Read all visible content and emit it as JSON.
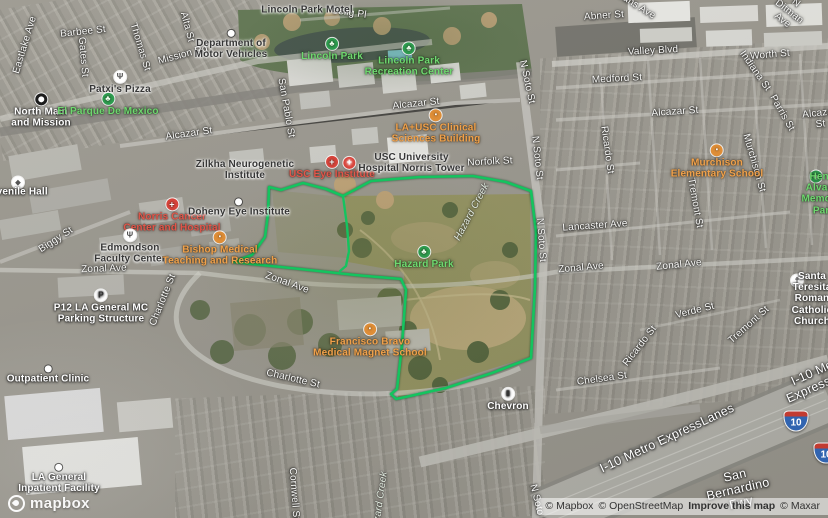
{
  "map": {
    "polygon_color": "#14c45f",
    "boundary": {
      "outer": [
        [
          269,
          187
        ],
        [
          281,
          190
        ],
        [
          303,
          183
        ],
        [
          326,
          189
        ],
        [
          343,
          196
        ],
        [
          371,
          181
        ],
        [
          420,
          177
        ],
        [
          473,
          176
        ],
        [
          506,
          182
        ],
        [
          531,
          191
        ],
        [
          536,
          232
        ],
        [
          535,
          287
        ],
        [
          531,
          358
        ],
        [
          492,
          373
        ],
        [
          446,
          388
        ],
        [
          410,
          396
        ],
        [
          396,
          399
        ],
        [
          391,
          394
        ],
        [
          397,
          389
        ],
        [
          402,
          345
        ],
        [
          406,
          290
        ],
        [
          401,
          279
        ],
        [
          355,
          275
        ],
        [
          300,
          269
        ],
        [
          233,
          262
        ],
        [
          252,
          255
        ],
        [
          265,
          237
        ],
        [
          268,
          214
        ],
        [
          269,
          187
        ]
      ],
      "divider": [
        [
          343,
          196
        ],
        [
          347,
          226
        ],
        [
          349,
          251
        ],
        [
          346,
          266
        ],
        [
          340,
          271
        ]
      ]
    },
    "icon_glyphs": {
      "park": "♣",
      "hospital": "+",
      "school": "▪",
      "restaurant": "Ψ",
      "parking": "P",
      "fuel": "▮",
      "church": "†",
      "civic": "◆",
      "metro": "",
      "dot": ""
    },
    "shields": [
      {
        "name": "interstate-10-shield",
        "x": 796,
        "y": 421,
        "label": "10"
      },
      {
        "name": "interstate-10-shield-clipped",
        "x": 826,
        "y": 453,
        "label": "10"
      }
    ],
    "labels": [
      {
        "name": "street-selig-pl",
        "text": "Selig Pl",
        "x": 349,
        "y": 13,
        "rot": 8,
        "cls": "street"
      },
      {
        "name": "street-abner-st",
        "text": "Abner St",
        "x": 604,
        "y": 16,
        "rot": -4,
        "cls": "street"
      },
      {
        "name": "street-n-ditman-ave",
        "text": "N Ditman Ave",
        "x": 789,
        "y": 12,
        "rot": 38,
        "cls": "street"
      },
      {
        "name": "street-evans-ave",
        "text": "Evans Ave",
        "x": 634,
        "y": 4,
        "rot": 32,
        "cls": "street"
      },
      {
        "name": "street-valley-blvd",
        "text": "Valley Blvd",
        "x": 653,
        "y": 51,
        "rot": -3,
        "cls": "street"
      },
      {
        "name": "street-worth-st",
        "text": "Worth St",
        "x": 770,
        "y": 55,
        "rot": -5,
        "cls": "street"
      },
      {
        "name": "street-medford-st",
        "text": "Medford St",
        "x": 617,
        "y": 79,
        "rot": -3,
        "cls": "street"
      },
      {
        "name": "street-alcazar-st-left",
        "text": "Alcazar St",
        "x": 189,
        "y": 134,
        "rot": -8,
        "cls": "street"
      },
      {
        "name": "street-alcazar-st-center",
        "text": "Alcazar St",
        "x": 416,
        "y": 104,
        "rot": -6,
        "cls": "street"
      },
      {
        "name": "street-alcazar-st-right",
        "text": "Alcazar St",
        "x": 675,
        "y": 112,
        "rot": -4,
        "cls": "street"
      },
      {
        "name": "street-alcazar-st-edge",
        "text": "Alcazar St",
        "x": 820,
        "y": 119,
        "rot": -6,
        "cls": "street"
      },
      {
        "name": "street-indiana-st",
        "text": "Indiana St",
        "x": 755,
        "y": 71,
        "rot": 55,
        "cls": "street"
      },
      {
        "name": "street-parris-st",
        "text": "Parris St",
        "x": 782,
        "y": 113,
        "rot": 60,
        "cls": "street"
      },
      {
        "name": "street-n-soto-st-1",
        "text": "N Soto St",
        "x": 527,
        "y": 82,
        "rot": 78,
        "cls": "street"
      },
      {
        "name": "street-n-soto-st-2",
        "text": "N Soto St",
        "x": 537,
        "y": 158,
        "rot": 84,
        "cls": "street"
      },
      {
        "name": "street-n-soto-st-3",
        "text": "N Soto St",
        "x": 541,
        "y": 240,
        "rot": 86,
        "cls": "street"
      },
      {
        "name": "street-n-soto-st-4",
        "text": "N Soto St",
        "x": 538,
        "y": 506,
        "rot": 76,
        "cls": "street"
      },
      {
        "name": "street-norfolk-st",
        "text": "Norfolk St",
        "x": 490,
        "y": 162,
        "rot": -3,
        "cls": "street"
      },
      {
        "name": "street-ricardo-st-north",
        "text": "Ricardo St",
        "x": 607,
        "y": 150,
        "rot": 82,
        "cls": "street"
      },
      {
        "name": "street-murchison-st",
        "text": "Murchison St",
        "x": 754,
        "y": 163,
        "rot": 74,
        "cls": "street"
      },
      {
        "name": "street-tremont-st-north",
        "text": "Tremont St",
        "x": 695,
        "y": 203,
        "rot": 80,
        "cls": "street"
      },
      {
        "name": "street-lancaster-ave",
        "text": "Lancaster Ave",
        "x": 595,
        "y": 226,
        "rot": -4,
        "cls": "street"
      },
      {
        "name": "street-zonal-ave-1",
        "text": "Zonal Ave",
        "x": 104,
        "y": 269,
        "rot": -2,
        "cls": "street"
      },
      {
        "name": "street-zonal-ave-2",
        "text": "Zonal Ave",
        "x": 287,
        "y": 283,
        "rot": 20,
        "cls": "street"
      },
      {
        "name": "street-zonal-ave-3",
        "text": "Zonal Ave",
        "x": 581,
        "y": 268,
        "rot": -5,
        "cls": "street"
      },
      {
        "name": "street-zonal-ave-4",
        "text": "Zonal Ave",
        "x": 679,
        "y": 265,
        "rot": -6,
        "cls": "street"
      },
      {
        "name": "street-charlotte-st-west",
        "text": "Charlotte St",
        "x": 163,
        "y": 300,
        "rot": -68,
        "cls": "street"
      },
      {
        "name": "street-charlotte-st-south",
        "text": "Charlotte St",
        "x": 293,
        "y": 379,
        "rot": 13,
        "cls": "street"
      },
      {
        "name": "street-biggy-st",
        "text": "Biggy St",
        "x": 56,
        "y": 240,
        "rot": -33,
        "cls": "street"
      },
      {
        "name": "street-mission-rd",
        "text": "Mission Rd",
        "x": 183,
        "y": 55,
        "rot": -15,
        "cls": "street"
      },
      {
        "name": "street-eastlake-ave",
        "text": "Eastlake Ave",
        "x": 25,
        "y": 45,
        "rot": -73,
        "cls": "street"
      },
      {
        "name": "street-barbee-st",
        "text": "Barbee St",
        "x": 83,
        "y": 32,
        "rot": -6,
        "cls": "street"
      },
      {
        "name": "street-gates-st",
        "text": "Gates St",
        "x": 83,
        "y": 57,
        "rot": 85,
        "cls": "street"
      },
      {
        "name": "street-thomas-st",
        "text": "Thomas St",
        "x": 140,
        "y": 47,
        "rot": 73,
        "cls": "street"
      },
      {
        "name": "street-alta-st",
        "text": "Alta St",
        "x": 187,
        "y": 27,
        "rot": 75,
        "cls": "street"
      },
      {
        "name": "street-san-pablo-st",
        "text": "San Pablo St",
        "x": 286,
        "y": 108,
        "rot": 80,
        "cls": "street"
      },
      {
        "name": "street-verde-st",
        "text": "Verde St",
        "x": 695,
        "y": 311,
        "rot": -14,
        "cls": "street"
      },
      {
        "name": "street-ricardo-st-south",
        "text": "Ricardo St",
        "x": 640,
        "y": 346,
        "rot": -52,
        "cls": "street"
      },
      {
        "name": "street-tremont-st-south",
        "text": "Tremont St",
        "x": 749,
        "y": 325,
        "rot": -42,
        "cls": "street"
      },
      {
        "name": "street-chelsea-st",
        "text": "Chelsea St",
        "x": 602,
        "y": 379,
        "rot": -8,
        "cls": "street"
      },
      {
        "name": "street-cornwell-st",
        "text": "Cornwell St",
        "x": 294,
        "y": 494,
        "rot": 86,
        "cls": "street"
      },
      {
        "name": "waterway-hazard-creek-1",
        "text": "Hazard Creek",
        "x": 472,
        "y": 212,
        "rot": -62,
        "cls": "creek"
      },
      {
        "name": "waterway-hazard-creek-2",
        "text": "Hazard Creek",
        "x": 380,
        "y": 503,
        "rot": -82,
        "cls": "creek"
      },
      {
        "name": "motorway-i10-metro-expresslanes",
        "text": "I-10 Metro ExpressLanes",
        "x": 667,
        "y": 438,
        "rot": -25,
        "cls": "motorway"
      },
      {
        "name": "motorway-i10-metro-expresslanes-edge",
        "text": "I-10 Metro ExpressLanes",
        "x": 822,
        "y": 376,
        "rot": -24,
        "cls": "motorway"
      },
      {
        "name": "motorway-san-bernardino-fwy",
        "text": "San Bernardino Fwy",
        "x": 738,
        "y": 489,
        "rot": -13,
        "cls": "motorway"
      },
      {
        "name": "poi-lincoln-park-motel",
        "text": "Lincoln Park Motel",
        "x": 307,
        "y": 10,
        "rot": 0,
        "cls": "poi-dark"
      },
      {
        "name": "poi-department-of-motor-vehicles",
        "text": "Department of\nMotor Vehicles",
        "x": 231,
        "y": 45,
        "rot": 0,
        "cls": "poi-dark",
        "icon": "dot"
      },
      {
        "name": "poi-patxis-pizza",
        "text": "Patxi's Pizza",
        "x": 120,
        "y": 83,
        "rot": 0,
        "cls": "poi-dark",
        "icon": "restaurant"
      },
      {
        "name": "poi-north-main-and-mission",
        "text": "North Main\nand Mission",
        "x": 41,
        "y": 111,
        "rot": 0,
        "cls": "poi-light",
        "icon": "metro"
      },
      {
        "name": "poi-el-parque-de-mexico",
        "text": "El Parque De Mexico",
        "x": 108,
        "y": 105,
        "rot": 0,
        "cls": "park",
        "icon": "park"
      },
      {
        "name": "poi-lincoln-park",
        "text": "Lincoln Park",
        "x": 332,
        "y": 50,
        "rot": 0,
        "cls": "park",
        "icon": "park"
      },
      {
        "name": "poi-lincoln-park-recreation-center",
        "text": "Lincoln Park\nRecreation Center",
        "x": 409,
        "y": 60,
        "rot": 0,
        "cls": "park",
        "icon": "park"
      },
      {
        "name": "poi-zilkha-neurogenetic-institute",
        "text": "Zilkha Neurogenetic\nInstitute",
        "x": 245,
        "y": 170,
        "rot": 0,
        "cls": "poi-dark"
      },
      {
        "name": "poi-usc-eye-institute",
        "text": "USC Eye Institute",
        "x": 332,
        "y": 168,
        "rot": 0,
        "cls": "hospital",
        "icon": "hospital"
      },
      {
        "name": "poi-usc-university-hospital-norris-tower",
        "text": "USC University\nHospital Norris Tower",
        "x": 404,
        "y": 163,
        "rot": 0,
        "cls": "poi-dark",
        "icon": "hospital",
        "iconpos": "left"
      },
      {
        "name": "poi-la-usc-clinical-sciences-building",
        "text": "LA+USC Clinical\nSciences Building",
        "x": 436,
        "y": 127,
        "rot": 0,
        "cls": "school",
        "icon": "school"
      },
      {
        "name": "poi-norris-cancer-center-and-hospital",
        "text": "Norris Cancer\nCenter and Hospital",
        "x": 172,
        "y": 216,
        "rot": 0,
        "cls": "hospital",
        "icon": "hospital"
      },
      {
        "name": "poi-doheny-eye-institute",
        "text": "Doheny Eye Institute",
        "x": 239,
        "y": 208,
        "rot": 0,
        "cls": "poi-dark",
        "icon": "dot"
      },
      {
        "name": "poi-edmondson-faculty-center",
        "text": "Edmondson\nFaculty Center",
        "x": 130,
        "y": 247,
        "rot": 0,
        "cls": "poi-dark",
        "icon": "restaurant"
      },
      {
        "name": "poi-bishop-medical-teaching-and-research",
        "text": "Bishop Medical\nTeaching and Research",
        "x": 220,
        "y": 249,
        "rot": 0,
        "cls": "school",
        "icon": "school"
      },
      {
        "name": "poi-central-juvenile-hall",
        "text": "Central Juvenile Hall",
        "x": -3,
        "y": 192,
        "rot": 0,
        "cls": "poi-light"
      },
      {
        "name": "poi-hazard-park",
        "text": "Hazard Park",
        "x": 424,
        "y": 258,
        "rot": 0,
        "cls": "park",
        "icon": "park"
      },
      {
        "name": "poi-henry-alvarez-memorial-park",
        "text": "Henry Alvarez\nMemorial Park",
        "x": 824,
        "y": 194,
        "rot": 0,
        "cls": "park"
      },
      {
        "name": "poi-murchison-elementary-school",
        "text": "Murchison\nElementary School",
        "x": 717,
        "y": 162,
        "rot": 0,
        "cls": "school",
        "icon": "school"
      },
      {
        "name": "poi-p12-la-general-mc-parking-structure",
        "text": "P12 LA General MC\nParking Structure",
        "x": 101,
        "y": 307,
        "rot": 0,
        "cls": "poi-light",
        "icon": "parking"
      },
      {
        "name": "poi-outpatient-clinic",
        "text": "Outpatient Clinic",
        "x": 48,
        "y": 375,
        "rot": 0,
        "cls": "poi-light",
        "icon": "dot"
      },
      {
        "name": "poi-francisco-bravo-medical-magnet-school",
        "text": "Francisco Bravo\nMedical Magnet School",
        "x": 370,
        "y": 341,
        "rot": 0,
        "cls": "school",
        "icon": "school"
      },
      {
        "name": "poi-la-general-inpatient-facility",
        "text": "LA General\nInpatient Facility",
        "x": 59,
        "y": 479,
        "rot": 0,
        "cls": "poi-light",
        "icon": "dot"
      },
      {
        "name": "poi-chevron",
        "text": "Chevron",
        "x": 508,
        "y": 400,
        "rot": 0,
        "cls": "poi-light",
        "icon": "fuel"
      },
      {
        "name": "poi-santa-teresita-roman-catholic-church",
        "text": "Santa Teresita Roman\nCatholic Church",
        "x": 812,
        "y": 299,
        "rot": 0,
        "cls": "poi-light"
      }
    ],
    "standalone_icons": [
      {
        "name": "central-juvenile-hall",
        "icon": "civic",
        "x": 18,
        "y": 183
      },
      {
        "name": "henry-alvarez-memorial-park",
        "icon": "park",
        "x": 816,
        "y": 177
      },
      {
        "name": "santa-teresita-church",
        "icon": "church",
        "x": 797,
        "y": 281
      }
    ]
  },
  "footer": {
    "logo_text": "mapbox",
    "attribution": [
      {
        "name": "mapbox-attribution",
        "label": "© Mapbox",
        "bold": false
      },
      {
        "name": "openstreetmap-attribution",
        "label": "© OpenStreetMap",
        "bold": false
      },
      {
        "name": "improve-this-map-link",
        "label": "Improve this map",
        "bold": true
      },
      {
        "name": "maxar-attribution",
        "label": "© Maxar",
        "bold": false
      }
    ]
  }
}
